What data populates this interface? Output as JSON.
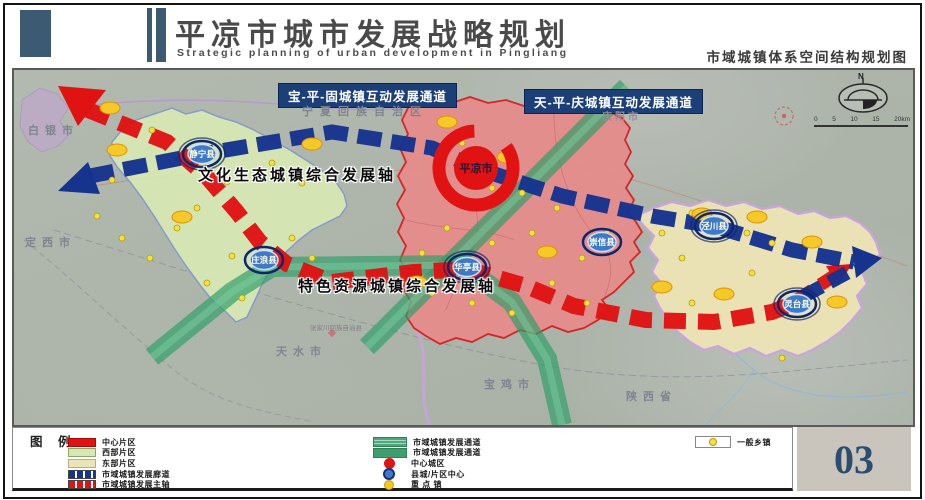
{
  "header": {
    "title": "平凉市城市发展战略规划",
    "subtitle": "Strategic planning of urban development in Pingliang",
    "map_title": "市域城镇体系空间结构规划图"
  },
  "map": {
    "corridors": {
      "bao_ping_gu": "宝-平-固城镇互动发展通道",
      "tian_ping_qing": "天-平-庆城镇互动发展通道"
    },
    "axes": {
      "culture": "文化生态城镇综合发展轴",
      "resource": "特色资源城镇综合发展轴"
    },
    "center_city": "平凉市",
    "counties": [
      "静宁县",
      "庄浪县",
      "华亭县",
      "崇信县",
      "泾川县",
      "灵台县"
    ],
    "neighbors": {
      "ningxia": "宁夏回族自治区",
      "baiyin": "白银市",
      "dingxi": "定西市",
      "tianshui": "天水市",
      "baoji": "宝鸡市",
      "shaanxi": "陕西省",
      "qingyang": "庆阳市",
      "zhangjiachuan": "张家川回族自治县"
    },
    "compass_north": "N",
    "scale_ticks": [
      "0",
      "5",
      "10",
      "15",
      "20km"
    ]
  },
  "legend": {
    "title": "图 例",
    "col1": [
      {
        "label": "中心片区"
      },
      {
        "label": "西部片区"
      },
      {
        "label": "东部片区"
      },
      {
        "label": "市域城镇发展廊道"
      },
      {
        "label": "市域城镇发展主轴"
      }
    ],
    "col2": [
      {
        "label": "市域城镇发展通道"
      },
      {
        "label": "市域城镇发展通道"
      },
      {
        "label": "中心城区"
      },
      {
        "label": "县城/片区中心"
      },
      {
        "label": "重 点 镇"
      }
    ],
    "col3": [
      {
        "label": "一般乡镇"
      }
    ]
  },
  "page_number": "03",
  "colors": {
    "header_navy": "#3d5a73",
    "corridor_blue": "#16338e",
    "axis_red": "#e01212",
    "channel_green": "#2f9e68",
    "west_region": "#d6e6b4",
    "center_region": "#e58c8c",
    "east_region": "#ece4b6",
    "page_number_bg": "#c9c5bd"
  }
}
